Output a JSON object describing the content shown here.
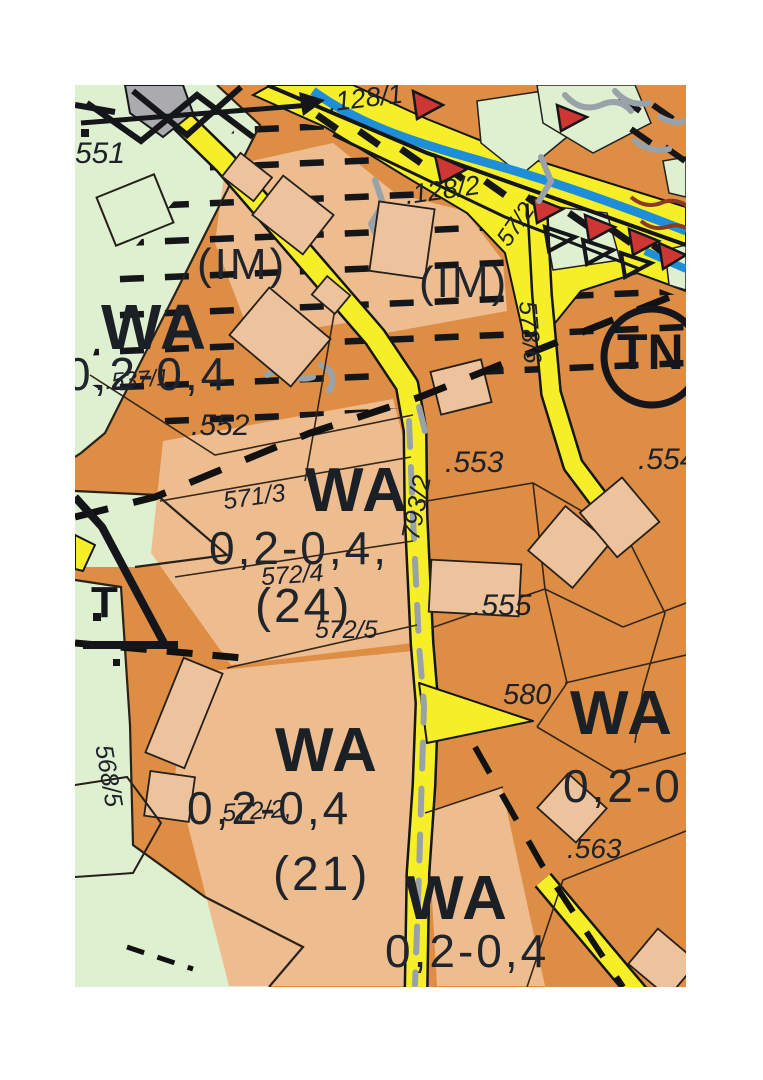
{
  "map": {
    "type": "zoning-plan-scan",
    "zones": {
      "top_left": {
        "label": "WA",
        "value": "0,2-0,4"
      },
      "center": {
        "label": "WA",
        "value": "0,2-0,4,",
        "number": "(24)"
      },
      "right": {
        "label": "WA",
        "value": "0,2-0"
      },
      "bottom_left": {
        "label": "WA",
        "value": "0,2-0,4",
        "number": "(21)"
      },
      "bottom_center": {
        "label": "WA",
        "value": "0,2-0,4"
      },
      "im_top": "(IM)",
      "im_right": "(IM)"
    },
    "parcels": {
      "p551": "551",
      "p128_1": ".128/1",
      "p128_2": ".128/2",
      "p537_1": ".537/1",
      "p552": ".552",
      "p553": ".553",
      "p554": ".554",
      "p555": ".555",
      "p563": ".563",
      "p580": "580",
      "p571_3": "571/3",
      "p572_4": "572/4",
      "p572_5": "572/5",
      "p572_2": "572/2,",
      "p568_5": "568/5",
      "p57_2": "57/2"
    },
    "roads": {
      "r793_2": "793/2",
      "r578_6": "578/6"
    },
    "symbols": {
      "tn_circle": "TN",
      "transformer": "T"
    },
    "colors": {
      "residential": "#de8d44",
      "residential_light": "#eebd8f",
      "green_space": "#dff0d0",
      "road": "#f6ef28",
      "water": "#1f8ed8",
      "hazard_marker": "#cd3632",
      "existing_gray": "#abaaae"
    }
  }
}
